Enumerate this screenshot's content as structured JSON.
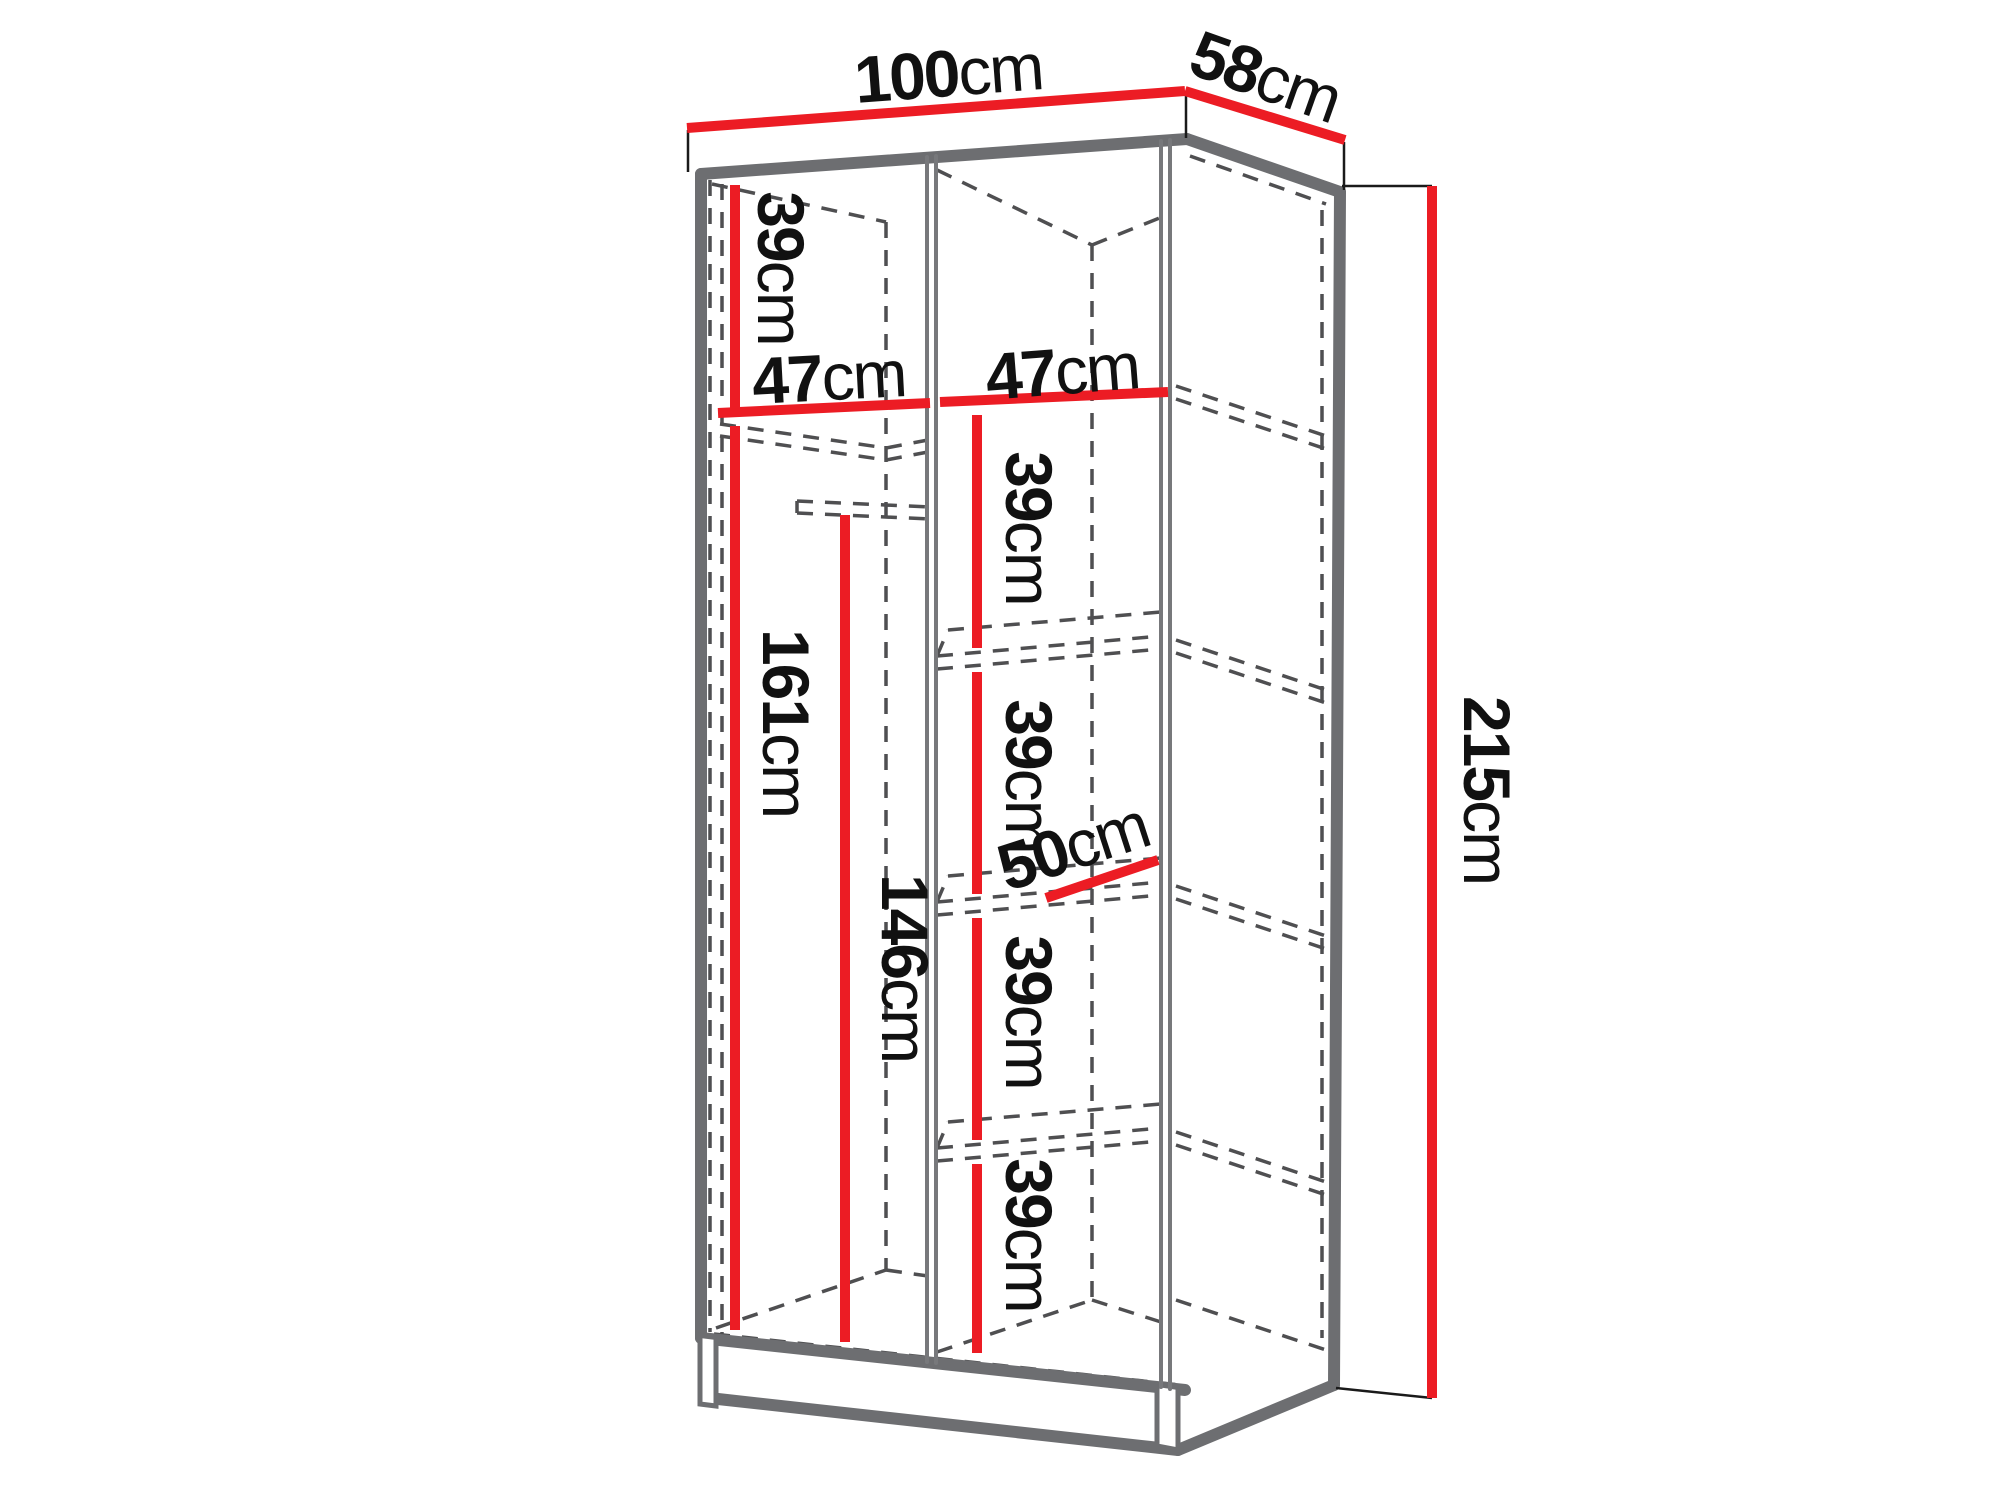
{
  "diagram": {
    "type": "furniture-dimension-diagram",
    "subject": "two-door wardrobe interior dimension drawing",
    "unit": "cm",
    "colors": {
      "dimension_line": "#ec1c24",
      "outline": "#6d6e71",
      "thin_line": "#1a1a1a",
      "dashed_line": "#4f4f51",
      "text": "#111111",
      "background": "#ffffff"
    },
    "dimensions": {
      "width": {
        "value": "100",
        "unit": "cm"
      },
      "depth": {
        "value": "58",
        "unit": "cm"
      },
      "height": {
        "value": "215",
        "unit": "cm"
      },
      "top_shelf_height": {
        "value": "39",
        "unit": "cm"
      },
      "left_section_width": {
        "value": "47",
        "unit": "cm"
      },
      "right_section_width": {
        "value": "47",
        "unit": "cm"
      },
      "left_section_height": {
        "value": "161",
        "unit": "cm"
      },
      "hanging_rail_height": {
        "value": "146",
        "unit": "cm"
      },
      "shelf_gap_1": {
        "value": "39",
        "unit": "cm"
      },
      "shelf_gap_2": {
        "value": "39",
        "unit": "cm"
      },
      "shelf_gap_3": {
        "value": "39",
        "unit": "cm"
      },
      "shelf_gap_4": {
        "value": "39",
        "unit": "cm"
      },
      "shelf_depth": {
        "value": "50",
        "unit": "cm"
      }
    }
  }
}
